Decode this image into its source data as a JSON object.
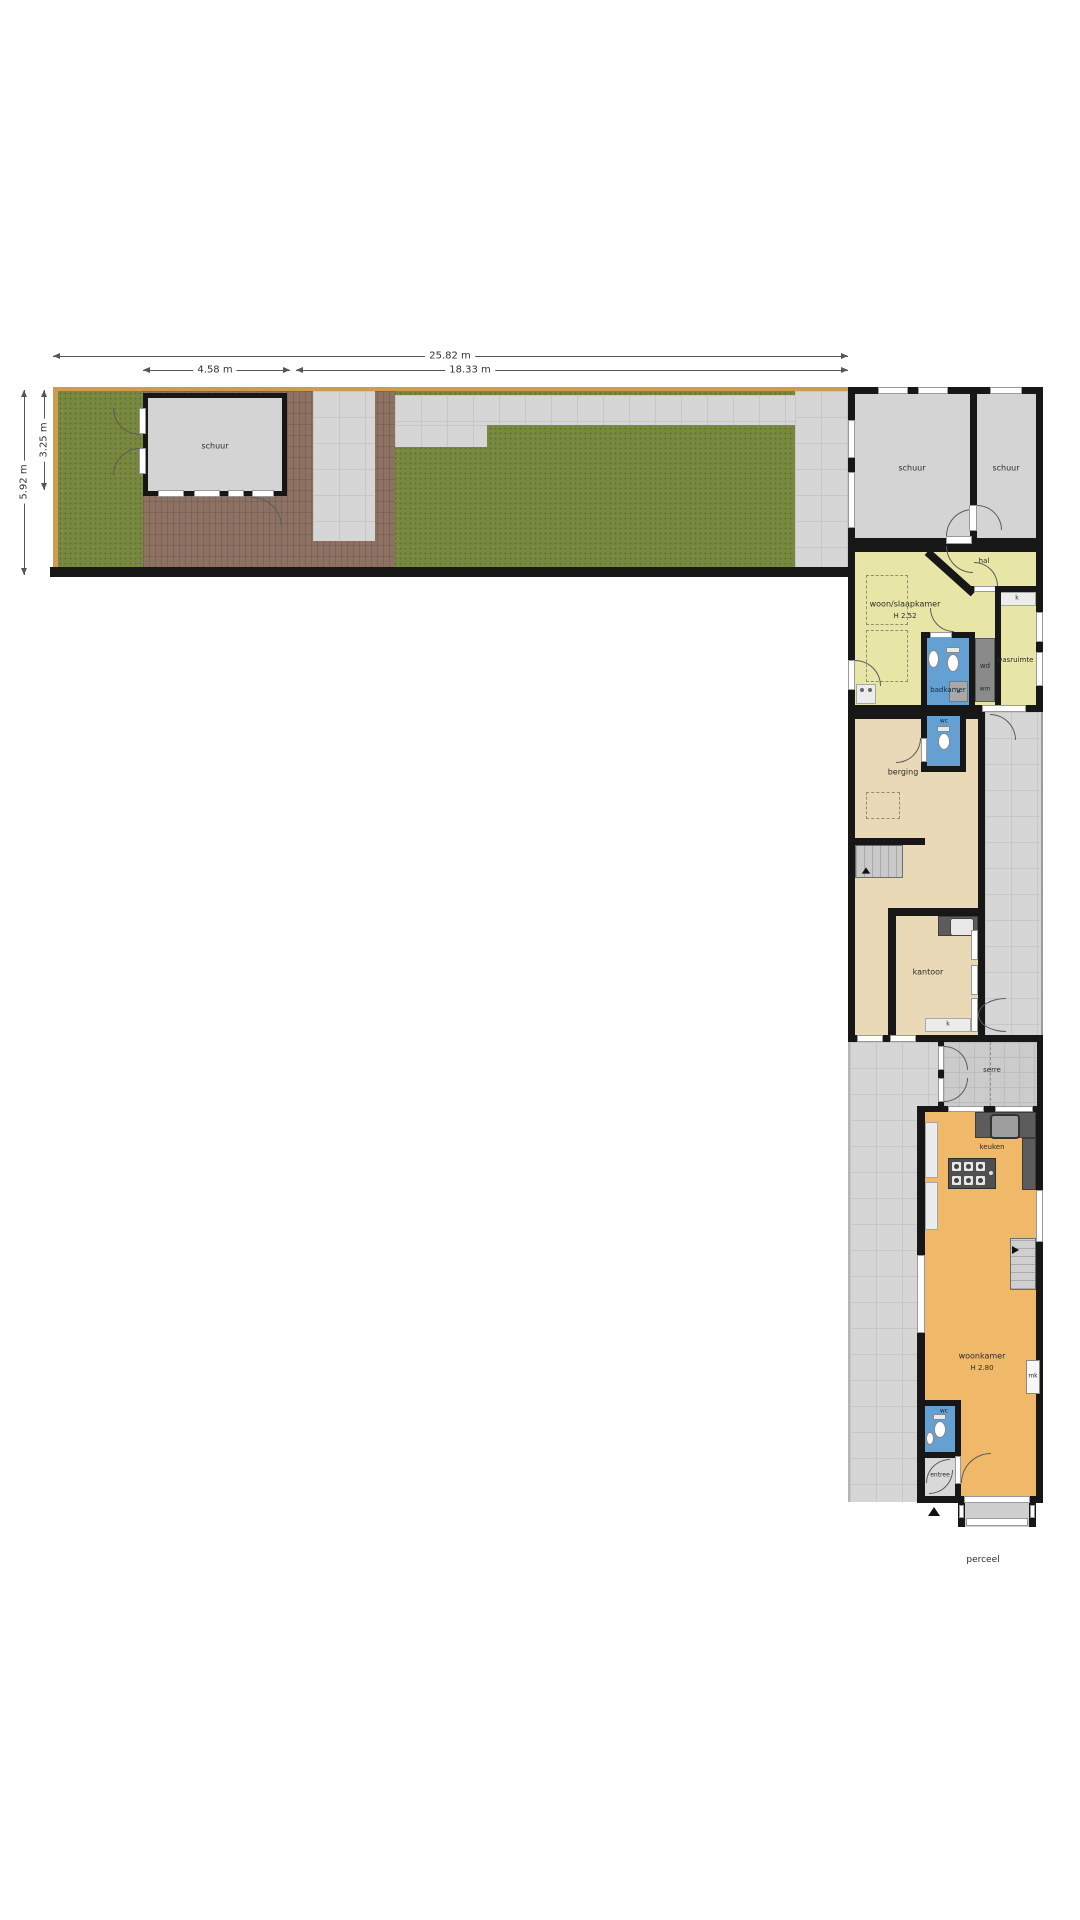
{
  "dimensions": {
    "total_width": "25.82 m",
    "shed_width": "4.58 m",
    "garden_width": "18.33 m",
    "garden_depth": "5.92 m",
    "shed_depth": "3.25 m"
  },
  "rooms": {
    "garden_shed": "schuur",
    "shed_left": "schuur",
    "shed_right": "schuur",
    "hall": "hal",
    "bedroom": "woon/slaapkamer",
    "bedroom_height": "H 2.52",
    "closet1": "k",
    "bathroom": "badkamer",
    "dryer": "wd",
    "washer": "wm",
    "laundry": "wasruimte",
    "wc1": "wc",
    "storage": "berging",
    "office": "kantoor",
    "closet2": "k",
    "conservatory": "serre",
    "kitchen": "keuken",
    "living": "woonkamer",
    "living_height": "H 2.80",
    "meter_cupboard": "mk",
    "wc2": "wc",
    "entry": "entree",
    "parcel": "perceel"
  },
  "colors": {
    "wall": "#171717",
    "grass": "#77893e",
    "brick": "#8d7263",
    "yellow_room": "#e7e6a6",
    "beige_room": "#ead9b6",
    "orange_room": "#f0b969",
    "blue_room": "#64a0d2"
  }
}
